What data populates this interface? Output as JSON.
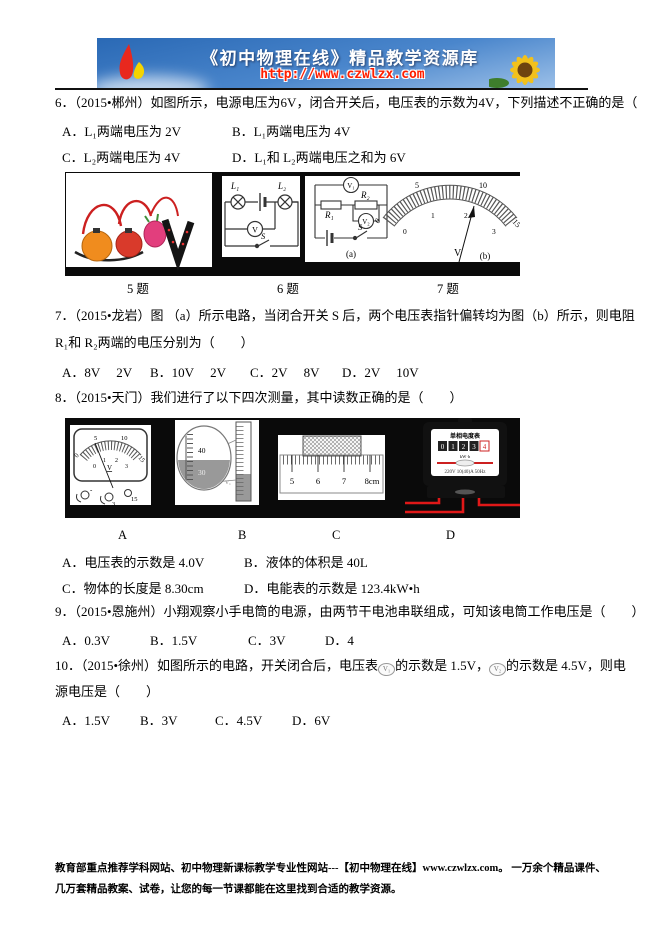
{
  "banner": {
    "title": "《初中物理在线》精品教学资源库",
    "url": "http://www.czwlzx.com"
  },
  "q6": {
    "stem": "6．（2015•郴州）如图所示，电源电压为6V，闭合开关后，电压表的示数为4V，下列描述不正确的是（　　）",
    "options": [
      "A．L₁两端电压为 2V",
      "B．L₁两端电压为 4V",
      "C．L₂两端电压为 4V",
      "D．L₁和 L₂两端电压之和为 6V"
    ]
  },
  "fig1": {
    "captions": [
      "5 题",
      "6 题",
      "7 题"
    ],
    "circuit6": {
      "l1": "L₁",
      "l2": "L₂",
      "v": "V",
      "s": "S"
    },
    "circuit7a": {
      "v1": "V₁",
      "v2": "V₂",
      "r1": "R₁",
      "r2": "R₂",
      "s": "S",
      "caption": "(a)"
    },
    "meter7b": {
      "outer": [
        "0",
        "5",
        "10",
        "15"
      ],
      "inner": [
        "0",
        "1",
        "2",
        "3"
      ],
      "unit": "V",
      "caption": "(b)"
    }
  },
  "q7": {
    "stem1": "7．（2015•龙岩）图 （a）所示电路，当闭合开关 S 后，两个电压表指针偏转均为图（b）所示，则电阻",
    "stem2": "R₁和 R₂两端的电压分别为（　　）",
    "options": [
      "A．8V　 2V",
      "B．10V　 2V",
      "C．2V　 8V",
      "D．2V　 10V"
    ]
  },
  "q8": {
    "stem": "8．（2015•天门）我们进行了以下四次测量，其中读数正确的是（　　）",
    "options": [
      "A．电压表的示数是 4.0V",
      "B．液体的体积是 40L",
      "C．物体的长度是 8.30cm",
      "D．电能表的示数是 123.4kW•h"
    ]
  },
  "fig2": {
    "captions": [
      "A",
      "B",
      "C",
      "D"
    ],
    "meterA": {
      "outer": [
        "0",
        "5",
        "10",
        "15"
      ],
      "inner": [
        "0",
        "1",
        "2",
        "3"
      ],
      "unit": "V",
      "terminals": [
        "-",
        "3",
        "15"
      ]
    },
    "cylB": {
      "t40": "40",
      "t30": "30",
      "label": "V₁"
    },
    "rulerC": {
      "ticks": [
        "5",
        "6",
        "7",
        "8cm"
      ]
    },
    "meterD": {
      "title": "单相电度表",
      "digits": [
        "0",
        "1",
        "2",
        "3",
        "4"
      ],
      "unit": "kW·h",
      "spec": "220V 10(40)A 50Hz"
    }
  },
  "q9": {
    "stem": "9．（2015•恩施州）小翔观察小手电筒的电源，由两节干电池串联组成，可知该电筒工作电压是（　　）",
    "options": [
      "A．0.3V",
      "B．1.5V",
      "C．3V",
      "D．4"
    ]
  },
  "q10": {
    "p1": "10．（2015•徐州）如图所示的电路，开关闭合后，电压表",
    "m1": "V₁",
    "p2": "的示数是 1.5V，",
    "m2": "V₂",
    "p3": "的示数是 4.5V，则电",
    "p4": "源电压是（　　）",
    "options": [
      "A．1.5V",
      "B．3V",
      "C．4.5V",
      "D．6V"
    ]
  },
  "footer": {
    "text": "教育部重点推荐学科网站、初中物理新课标教学专业性网站---【初中物理在线】www.czwlzx.com。 一万余个精品课件、几万套精品教案、试卷，让您的每一节课都能在这里找到合适的教学资源。"
  },
  "colors": {
    "url_red": "#ff1f00",
    "wire_red": "#cc2020",
    "strip_black": "#0a0a0a"
  }
}
